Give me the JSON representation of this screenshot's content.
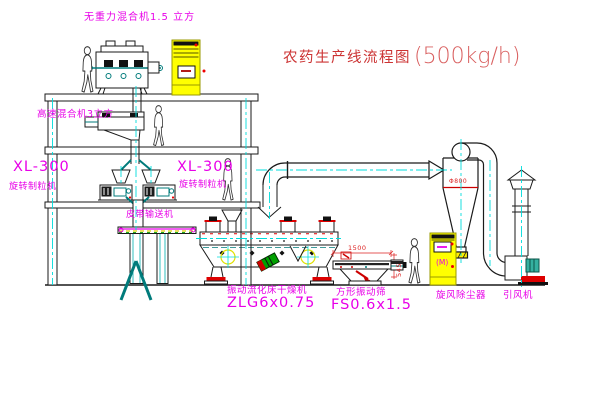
{
  "title": {
    "text": "农药生产线流程图",
    "capacity": "(500kg/h)"
  },
  "equipment_labels": {
    "gravity_free_mixer": "无重力混合机1.5 立方",
    "high_speed_mixer": "高速混合机3立方",
    "granulator_left_model": "XL-300",
    "granulator_left_name": "旋转制粒机",
    "granulator_right_model": "XL-300",
    "granulator_right_name": "旋转制粒机",
    "belt_conveyor": "皮带输送机",
    "fluid_bed_dryer_name": "振动流化床干燥机",
    "fluid_bed_dryer_model": "ZLG6x0.75",
    "vibrating_screen_name": "方形振动筛",
    "vibrating_screen_model": "FS0.6x1.5",
    "cyclone": "旋风除尘器",
    "induced_draft_fan": "引风机"
  },
  "annotations": {
    "screen_width_dim": "1500",
    "screen_height_dim": "545",
    "cyclone_diameter": "Φ800",
    "cabinet_motor_mark": "(M)"
  },
  "colors": {
    "label_magenta": "#e800e8",
    "title_red": "#cc3333",
    "centerline_cyan": "#00dcdc",
    "machine_teal": "#007b7b",
    "cabinet_yellow": "#ffff00",
    "dimension_red": "#dd2222",
    "line_black": "#1a1a1a"
  }
}
